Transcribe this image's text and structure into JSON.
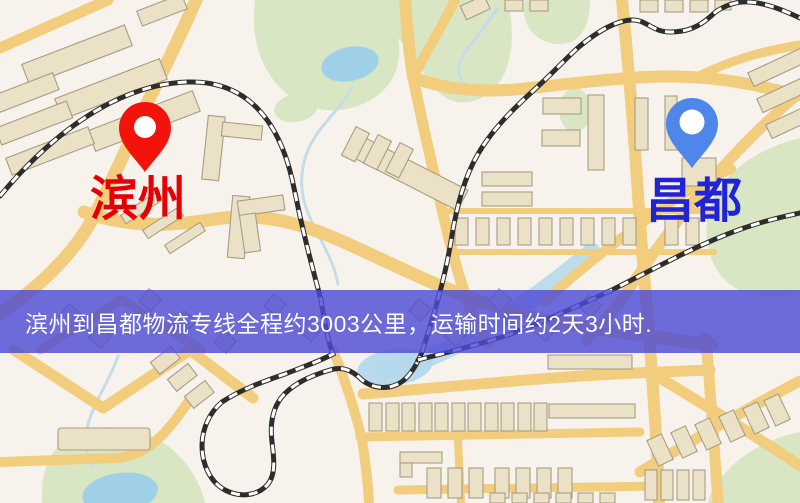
{
  "page": {
    "width": 800,
    "height": 503,
    "kind": "logistics-route-map"
  },
  "map": {
    "markers": [
      {
        "name": "origin",
        "label": "滨州"
      },
      {
        "name": "destination",
        "label": "昌都"
      }
    ],
    "features": [
      "roads",
      "railways",
      "buildings",
      "parks",
      "lakes",
      "river"
    ]
  },
  "banner": {
    "text": "滨州到昌都物流专线全程约3003公里，运输时间约2天3小时."
  },
  "theme": {
    "background": "#f7f3ec",
    "road": "#f2cd7d",
    "building-fill": "#eae1c6",
    "building-stroke": "#a79d85",
    "park": "#d8e6c3",
    "water": "#9fd0e8",
    "stream": "#c6dce8",
    "river": "#b4d8ec",
    "railway-dark": "#2e2d2b",
    "railway-light": "#ffffff",
    "origin-pin": "#f2140a",
    "origin-label": "#e60005",
    "destination-pin": "#4f86ea",
    "destination-label": "#2123d6",
    "banner-bg": "rgba(78,76,214,0.82)",
    "banner-text": "#ffffff"
  }
}
